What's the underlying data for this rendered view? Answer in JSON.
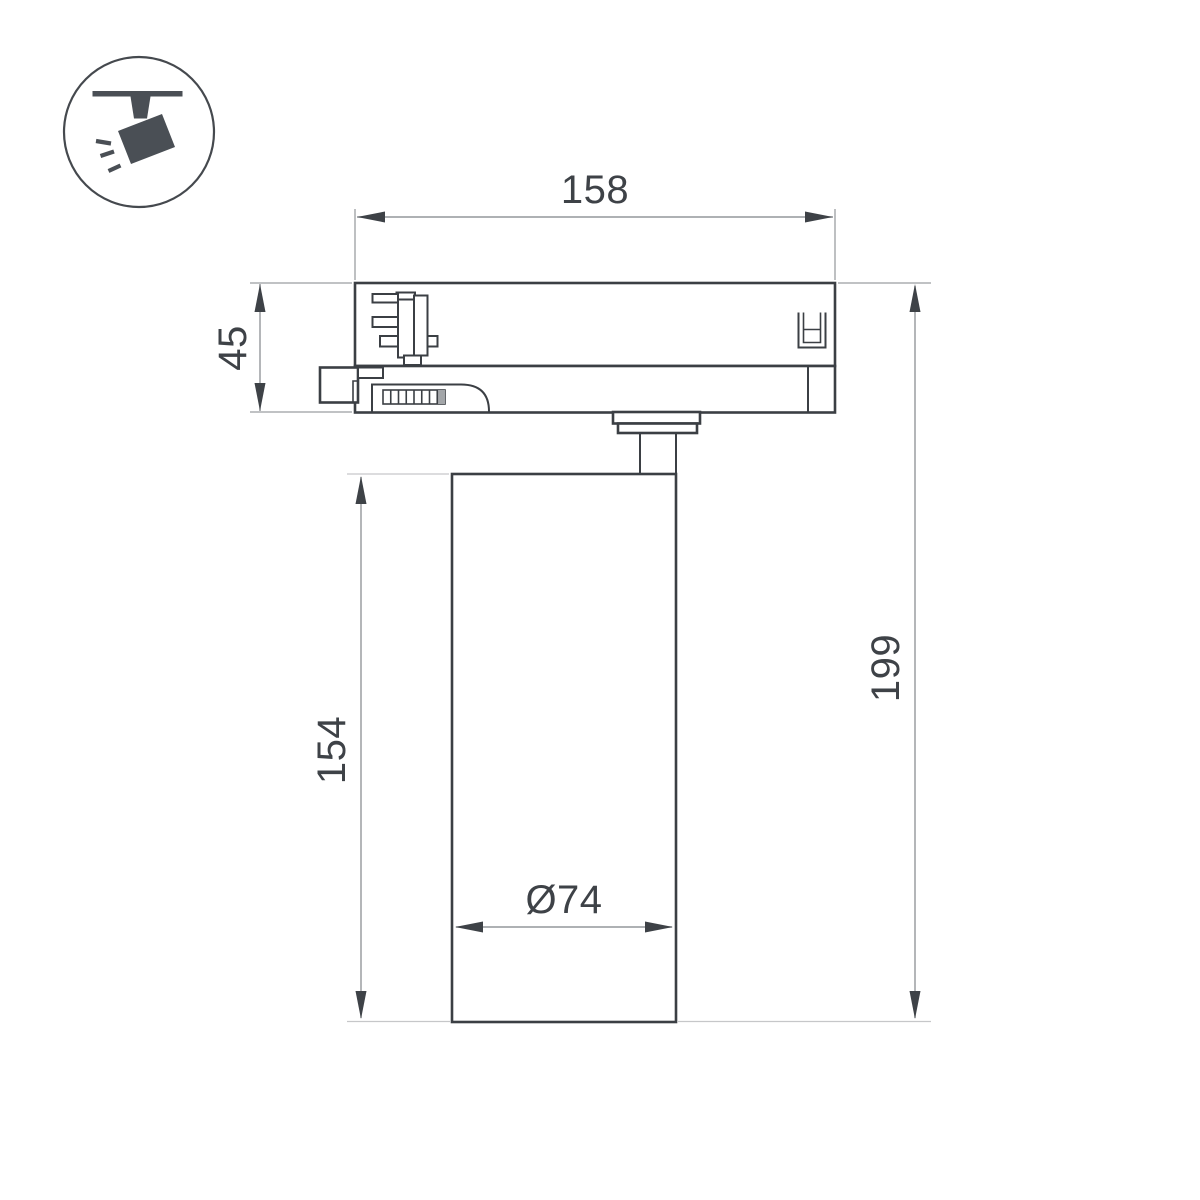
{
  "page": {
    "background": "#ffffff"
  },
  "icon": {
    "name": "ceiling-track-spotlight",
    "color": "#4a4f55"
  },
  "drawing": {
    "kind": "technical-dimension-drawing",
    "labels": {
      "adapter_width": "158",
      "adapter_height": "45",
      "body_height": "154",
      "total_height": "199",
      "body_diameter": "Ø74"
    },
    "colors": {
      "outline": "#3b3f44",
      "dimension_line": "#94979b",
      "extension_line": "#c6c7c9",
      "text": "#3e4247"
    }
  }
}
